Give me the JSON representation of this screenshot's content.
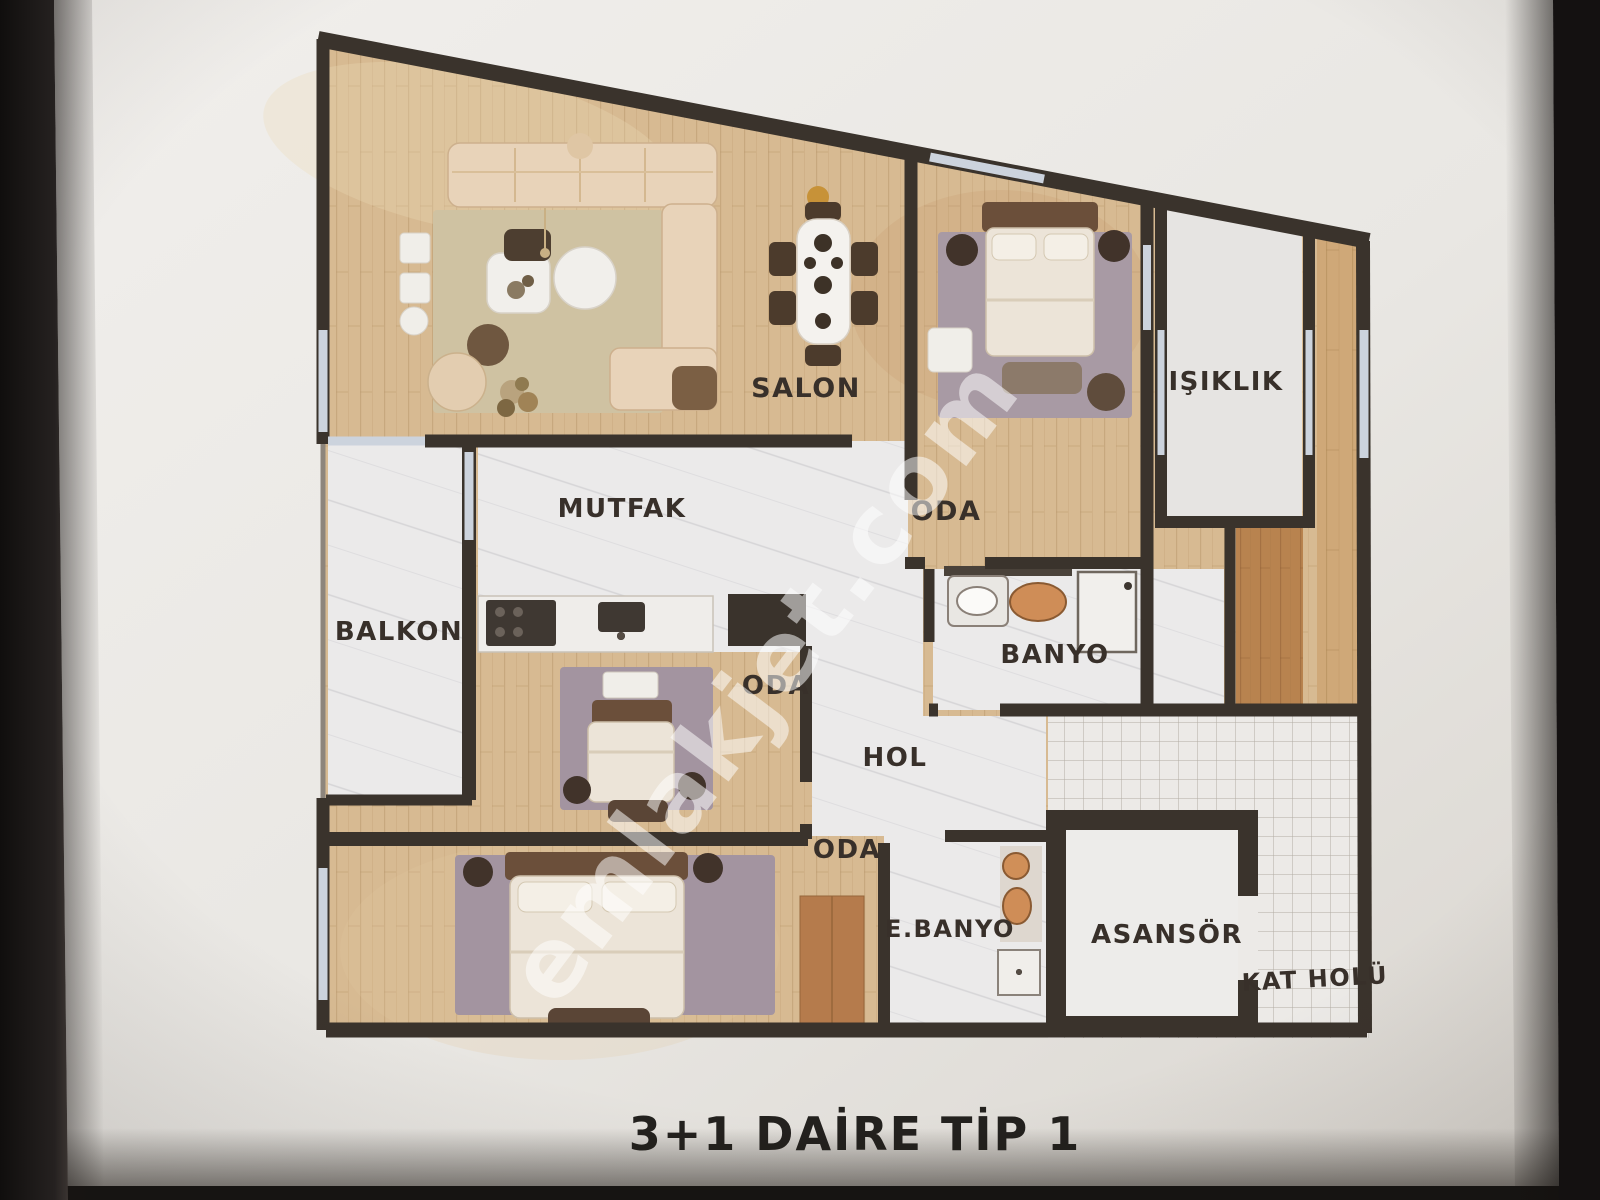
{
  "photo": {
    "paper_color": "#e9e7e3",
    "background_color": "#141211",
    "title": "3+1 DAİRE TİP 1",
    "watermark": "emlakjet.com"
  },
  "plan": {
    "type": "apartment-floor-plan",
    "rooms": [
      {
        "id": "salon",
        "label": "SALON"
      },
      {
        "id": "mutfak",
        "label": "MUTFAK"
      },
      {
        "id": "balkon",
        "label": "BALKON"
      },
      {
        "id": "oda-top-right",
        "label": "ODA"
      },
      {
        "id": "oda-middle",
        "label": "ODA"
      },
      {
        "id": "oda-bottom-left",
        "label": "ODA"
      },
      {
        "id": "hol",
        "label": "HOL"
      },
      {
        "id": "banyo",
        "label": "BANYO"
      },
      {
        "id": "isiklik",
        "label": "IŞIKLIK"
      },
      {
        "id": "e-banyo",
        "label": "E.BANYO"
      },
      {
        "id": "asansor",
        "label": "ASANSÖR"
      },
      {
        "id": "kat-holu",
        "label": "KAT HOLÜ"
      }
    ],
    "colors": {
      "wall": "#3a332c",
      "wood_floor": "#d7ba92",
      "wood_dark": "#b8834f",
      "white_floor": "#ebeaea",
      "window": "#ccd3dd",
      "rug_beige": "#cfc2a2",
      "rug_mauve": "#a394a0",
      "label_text": "#38302a"
    }
  }
}
